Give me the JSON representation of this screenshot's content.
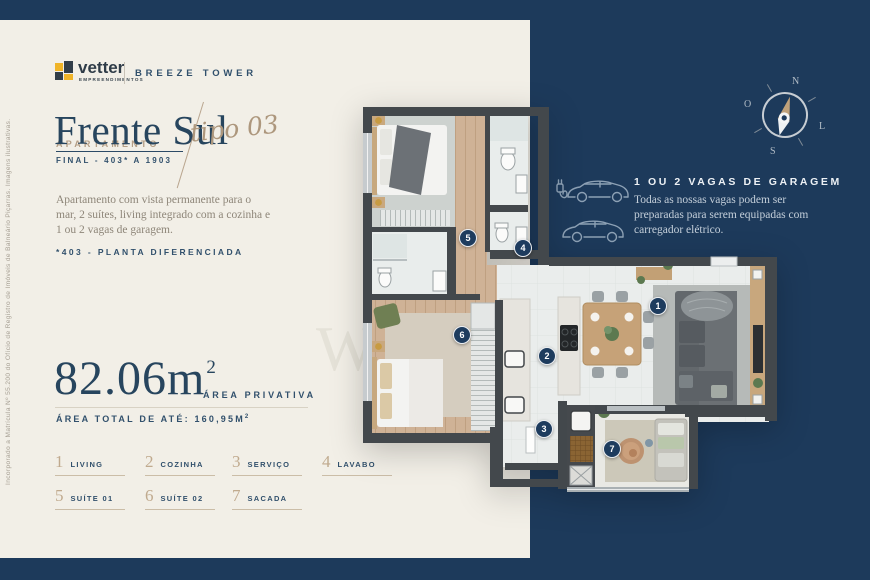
{
  "brand": {
    "name": "vetter",
    "subtitle": "EMPREENDIMENTOS",
    "project": "BREEZE TOWER"
  },
  "side_note": "Incorporado a Matrícula Nº 55.200 do Ofício de Registro de Imóveis de Balneário Piçarras. Imagens ilustrativas.",
  "title_block": {
    "eyebrow": "APARTAMENTO",
    "title": "Frente Sul",
    "script": "tipo 03",
    "final_range": "FINAL - 403* A 1903"
  },
  "description": "Apartamento com vista permanente para o mar, 2 suítes, living integrado com a cozinha e 1 ou 2 vagas de garagem.",
  "plan_note": "*403 - PLANTA DIFERENCIADA",
  "area": {
    "value": "82.06m",
    "sup": "2",
    "label": "ÁREA PRIVATIVA",
    "total_prefix": "ÁREA TOTAL DE ATÉ: 160,95M",
    "total_sup": "2"
  },
  "legend": {
    "items": [
      {
        "num": "1",
        "label": "LIVING"
      },
      {
        "num": "2",
        "label": "COZINHA"
      },
      {
        "num": "3",
        "label": "SERVIÇO"
      },
      {
        "num": "4",
        "label": "LAVABO"
      },
      {
        "num": "5",
        "label": "SUÍTE 01"
      },
      {
        "num": "6",
        "label": "SUÍTE 02"
      },
      {
        "num": "7",
        "label": "SACADA"
      }
    ]
  },
  "garage": {
    "title": "1 OU 2 VAGAS DE GARAGEM",
    "body": "Todas as nossas vagas podem ser preparadas para serem equipadas com carregador elétrico."
  },
  "compass": {
    "north": "N",
    "west": "O",
    "south": "S",
    "east": "L"
  },
  "plan": {
    "watermark": "W",
    "markers": [
      {
        "n": "1",
        "x": 302,
        "y": 230
      },
      {
        "n": "2",
        "x": 191,
        "y": 280
      },
      {
        "n": "3",
        "x": 188,
        "y": 353
      },
      {
        "n": "4",
        "x": 167,
        "y": 172
      },
      {
        "n": "5",
        "x": 112,
        "y": 162
      },
      {
        "n": "6",
        "x": 106,
        "y": 259
      },
      {
        "n": "7",
        "x": 256,
        "y": 373
      }
    ]
  },
  "colors": {
    "navy": "#1d3a5b",
    "cream": "#f2efe7",
    "tan": "#b49e85",
    "gold": "#f0b428",
    "wall": "#43484c"
  }
}
